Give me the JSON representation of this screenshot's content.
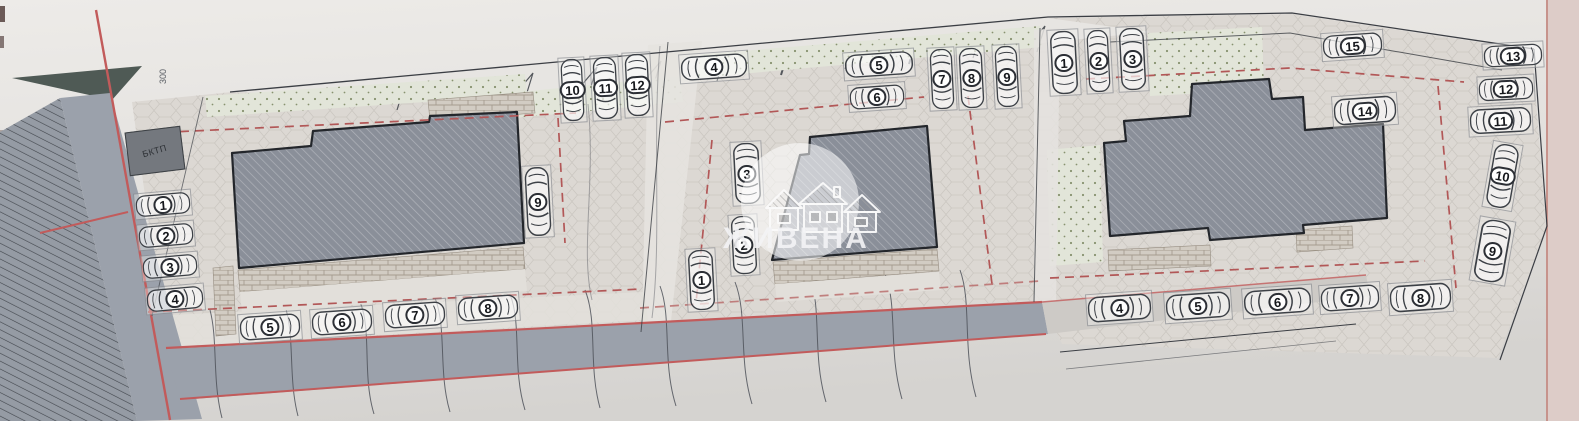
{
  "plan": {
    "type": "site-plan",
    "watermark": {
      "brand": "ЖИВЕНА"
    },
    "labels": {
      "transformer": "БКТП",
      "elevation_mark": "300"
    },
    "buildings_count": 3,
    "parking_zones": [
      {
        "name": "building-1-parking",
        "spots": [
          "1",
          "2",
          "3",
          "4",
          "5",
          "6",
          "7",
          "8",
          "9",
          "10",
          "11",
          "12"
        ]
      },
      {
        "name": "building-2-parking",
        "spots": [
          "1",
          "2",
          "3",
          "4",
          "5",
          "6",
          "7",
          "8",
          "9"
        ]
      },
      {
        "name": "building-3-parking",
        "spots": [
          "1",
          "2",
          "3",
          "4",
          "5",
          "6",
          "7",
          "8",
          "9",
          "10",
          "11",
          "12",
          "13",
          "14",
          "15"
        ]
      }
    ],
    "colors": {
      "building_fill": "#8a8f99",
      "boundary_red": "#c25b5b",
      "dashed_red": "#b25757",
      "road_gray": "#9ba1ab",
      "green_area": "#e2e5d9",
      "paper": "#e2e0dd"
    }
  }
}
